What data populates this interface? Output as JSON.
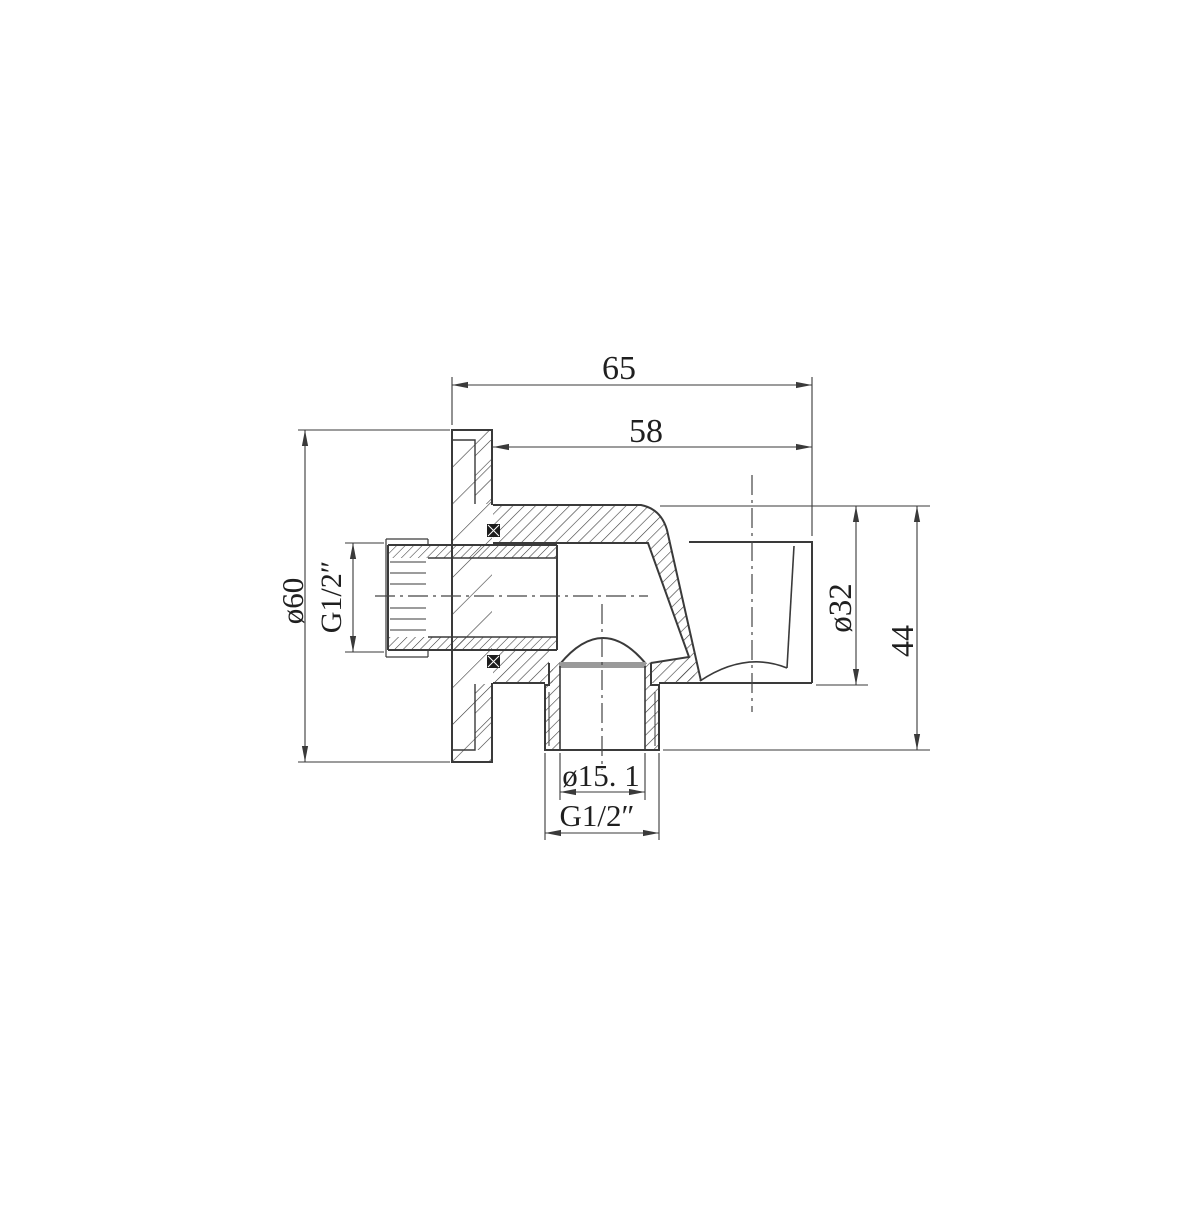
{
  "drawing": {
    "kind": "technical-section-drawing",
    "subject": "wall-mounted shower outlet elbow with handset holder, cross-section",
    "background_color": "#ffffff",
    "line_color": "#3a3a3a",
    "seal_line_color": "#9a9a9a",
    "labels": {
      "overall_width": "65",
      "body_width": "58",
      "flange_diameter": "ø60",
      "inlet_thread": "G1/2″",
      "holder_diameter": "ø32",
      "overall_height": "44",
      "outlet_bore": "ø15. 1",
      "outlet_thread": "G1/2″"
    }
  }
}
